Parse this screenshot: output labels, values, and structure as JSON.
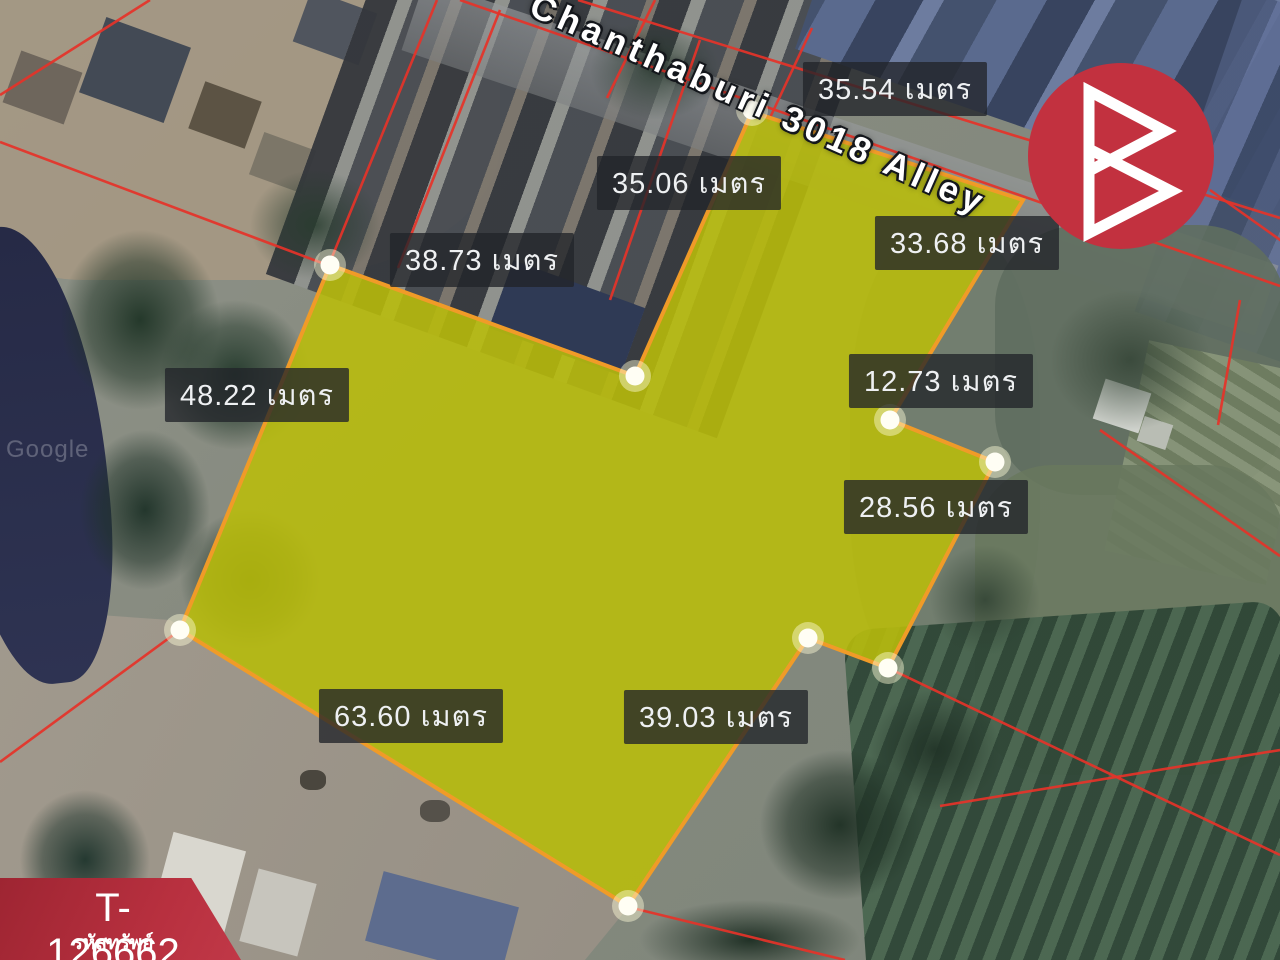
{
  "map": {
    "road_label": "Chanthaburi 3018 Alley",
    "watermark": "Google",
    "unit": "เมตร",
    "measurements": [
      {
        "label": "35.54 เมตร",
        "x": 895,
        "y": 89
      },
      {
        "label": "35.06 เมตร",
        "x": 689,
        "y": 183
      },
      {
        "label": "33.68 เมตร",
        "x": 967,
        "y": 243
      },
      {
        "label": "38.73 เมตร",
        "x": 482,
        "y": 260
      },
      {
        "label": "48.22 เมตร",
        "x": 257,
        "y": 395
      },
      {
        "label": "12.73 เมตร",
        "x": 941,
        "y": 381
      },
      {
        "label": "28.56 เมตร",
        "x": 936,
        "y": 507
      },
      {
        "label": "63.60 เมตร",
        "x": 411,
        "y": 716
      },
      {
        "label": "39.03 เมตร",
        "x": 716,
        "y": 717
      }
    ],
    "plot": {
      "fill": "#b9bd0a",
      "fill_opacity": 0.88,
      "stroke": "#f09b28",
      "points": [
        [
          752,
          112
        ],
        [
          1023,
          200
        ],
        [
          890,
          420
        ],
        [
          995,
          462
        ],
        [
          888,
          668
        ],
        [
          808,
          638
        ],
        [
          628,
          906
        ],
        [
          180,
          630
        ],
        [
          330,
          265
        ],
        [
          635,
          376
        ]
      ],
      "vertex_dots": [
        [
          752,
          110
        ],
        [
          330,
          265
        ],
        [
          635,
          376
        ],
        [
          890,
          420
        ],
        [
          995,
          462
        ],
        [
          180,
          630
        ],
        [
          808,
          638
        ],
        [
          888,
          668
        ],
        [
          628,
          906
        ]
      ]
    },
    "red_lines": [
      [
        460,
        0,
        1280,
        286
      ],
      [
        578,
        0,
        1280,
        218
      ],
      [
        655,
        0,
        607,
        98
      ],
      [
        812,
        28,
        768,
        122
      ],
      [
        437,
        0,
        330,
        262
      ],
      [
        500,
        10,
        398,
        268
      ],
      [
        0,
        95,
        150,
        0
      ],
      [
        0,
        142,
        330,
        266
      ],
      [
        180,
        630,
        0,
        762
      ],
      [
        628,
        907,
        845,
        960
      ],
      [
        888,
        668,
        1280,
        855
      ],
      [
        940,
        806,
        1280,
        750
      ],
      [
        1100,
        430,
        1280,
        556
      ],
      [
        1210,
        190,
        1283,
        242
      ],
      [
        1240,
        300,
        1218,
        425
      ],
      [
        700,
        40,
        610,
        300
      ]
    ]
  },
  "branding": {
    "logo_color": "#c2313f"
  },
  "property_badge": {
    "code": "T-126662",
    "caption": "รหัสทรัพย์"
  }
}
